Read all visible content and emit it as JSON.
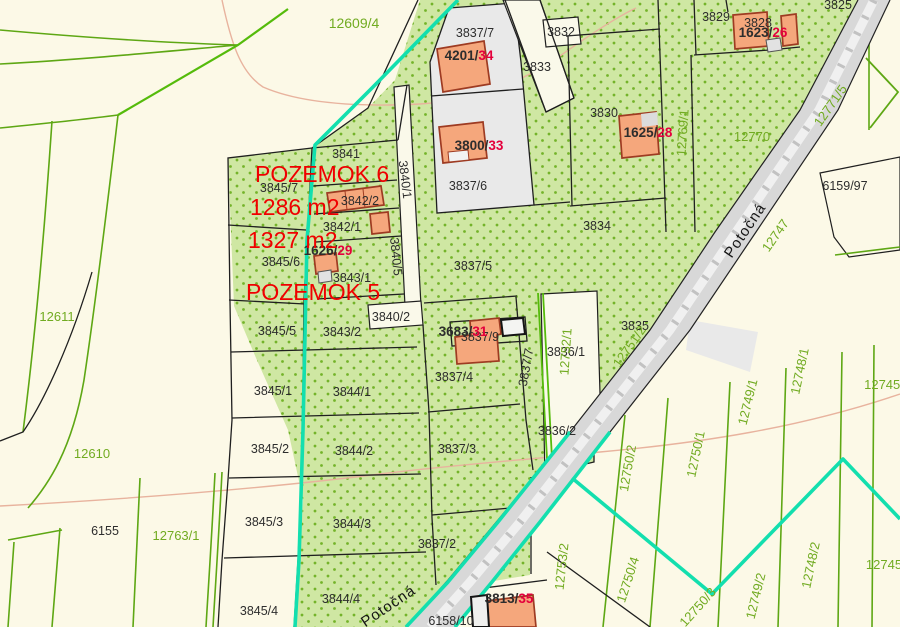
{
  "map_title": "cadastral-parcel-map",
  "colors": {
    "background": "#fcf9e7",
    "green_area": "#cfe7a3",
    "green_dot": "#74b32a",
    "gray_parcel": "#e9e9e9",
    "white_parcel": "#faf9ea",
    "road_fill": "#d8d8d8",
    "boundary_black": "#1f1f1f",
    "boundary_green": "#5ea714",
    "boundary_bright_green": "#55bb0b",
    "highlight_cyan": "#13dfae",
    "building_fill": "#f5a77c",
    "building_stroke": "#9e3b22",
    "contour_pink": "#e8b39e",
    "label_black": "#2d2d2d",
    "label_green": "#71ab21",
    "label_red": "#e4003c",
    "annotation_red": "#f00000",
    "street_black": "#151515"
  },
  "parcel_labels_black": [
    {
      "t": "3837/7",
      "x": 475,
      "y": 37
    },
    {
      "t": "3832",
      "x": 561,
      "y": 36
    },
    {
      "t": "3833",
      "x": 537,
      "y": 71
    },
    {
      "t": "3829",
      "x": 716,
      "y": 21
    },
    {
      "t": "3828",
      "x": 758,
      "y": 27
    },
    {
      "t": "3825",
      "x": 838,
      "y": 9
    },
    {
      "t": "3830",
      "x": 604,
      "y": 117
    },
    {
      "t": "3834",
      "x": 597,
      "y": 230
    },
    {
      "t": "6159/97",
      "x": 845,
      "y": 190
    },
    {
      "t": "3841",
      "x": 346,
      "y": 158
    },
    {
      "t": "3845/7",
      "x": 279,
      "y": 192
    },
    {
      "t": "3842/2",
      "x": 360,
      "y": 205
    },
    {
      "t": "3842/1",
      "x": 342,
      "y": 231
    },
    {
      "t": "3845/6",
      "x": 281,
      "y": 266
    },
    {
      "t": "3843/1",
      "x": 352,
      "y": 282
    },
    {
      "t": "3840/2",
      "x": 391,
      "y": 321
    },
    {
      "t": "3845/5",
      "x": 277,
      "y": 335
    },
    {
      "t": "3843/2",
      "x": 342,
      "y": 336
    },
    {
      "t": "3845/1",
      "x": 273,
      "y": 395
    },
    {
      "t": "3844/1",
      "x": 352,
      "y": 396
    },
    {
      "t": "3845/2",
      "x": 270,
      "y": 453
    },
    {
      "t": "3844/2",
      "x": 354,
      "y": 455
    },
    {
      "t": "3845/3",
      "x": 264,
      "y": 526
    },
    {
      "t": "3844/3",
      "x": 352,
      "y": 528
    },
    {
      "t": "3845/4",
      "x": 259,
      "y": 615
    },
    {
      "t": "3844/4",
      "x": 341,
      "y": 603
    },
    {
      "t": "3837/6",
      "x": 468,
      "y": 190
    },
    {
      "t": "3837/5",
      "x": 473,
      "y": 270
    },
    {
      "t": "3837/4",
      "x": 454,
      "y": 381
    },
    {
      "t": "3837/3",
      "x": 457,
      "y": 453
    },
    {
      "t": "3837/2",
      "x": 437,
      "y": 548
    },
    {
      "t": "3836/1",
      "x": 566,
      "y": 356
    },
    {
      "t": "3836/2",
      "x": 557,
      "y": 435
    },
    {
      "t": "3835",
      "x": 635,
      "y": 330
    },
    {
      "t": "6155",
      "x": 105,
      "y": 535
    },
    {
      "t": "6158/10",
      "x": 451,
      "y": 625
    },
    {
      "t": "3837/9",
      "x": 480,
      "y": 341,
      "u": 1
    },
    {
      "t": "3840/1",
      "x": 401,
      "y": 180,
      "r": 83
    },
    {
      "t": "3840/5",
      "x": 392,
      "y": 257,
      "r": 84
    },
    {
      "t": "3837/7",
      "x": 530,
      "y": 368,
      "r": -80
    }
  ],
  "parcel_labels_green": [
    {
      "t": "12609/4",
      "x": 354,
      "y": 28,
      "s": 14
    },
    {
      "t": "12611",
      "x": 57,
      "y": 321
    },
    {
      "t": "12610",
      "x": 92,
      "y": 458
    },
    {
      "t": "12763/1",
      "x": 176,
      "y": 540
    },
    {
      "t": "12770",
      "x": 752,
      "y": 141
    },
    {
      "t": "12769/1",
      "x": 687,
      "y": 133,
      "r": -86
    },
    {
      "t": "12747",
      "x": 779,
      "y": 238,
      "r": -55
    },
    {
      "t": "12771/5",
      "x": 834,
      "y": 108,
      "r": -55
    },
    {
      "t": "12751/2",
      "x": 633,
      "y": 349,
      "r": -55
    },
    {
      "t": "12752/1",
      "x": 570,
      "y": 352,
      "r": -86
    },
    {
      "t": "12753/2",
      "x": 566,
      "y": 567,
      "r": -84
    },
    {
      "t": "12750/2",
      "x": 632,
      "y": 469,
      "r": -80
    },
    {
      "t": "12750/1",
      "x": 700,
      "y": 455,
      "r": -78
    },
    {
      "t": "12750/4",
      "x": 632,
      "y": 581,
      "r": -72
    },
    {
      "t": "12750/3",
      "x": 701,
      "y": 610,
      "r": -48
    },
    {
      "t": "12749/2",
      "x": 760,
      "y": 597,
      "r": -76
    },
    {
      "t": "12748/2",
      "x": 815,
      "y": 566,
      "r": -78
    },
    {
      "t": "12749/1",
      "x": 752,
      "y": 403,
      "r": -76
    },
    {
      "t": "12748/1",
      "x": 804,
      "y": 372,
      "r": -78
    },
    {
      "t": "12745/",
      "x": 884,
      "y": 389
    },
    {
      "t": "12745",
      "x": 884,
      "y": 569
    }
  ],
  "building_labels": [
    {
      "black": "4201/",
      "red": "34",
      "x": 469,
      "y": 60
    },
    {
      "black": "1623/",
      "red": "26",
      "x": 763,
      "y": 37
    },
    {
      "black": "1625/",
      "red": "28",
      "x": 648,
      "y": 137
    },
    {
      "black": "3800/",
      "red": "33",
      "x": 479,
      "y": 150
    },
    {
      "black": "1626/",
      "red": "29",
      "x": 328,
      "y": 255
    },
    {
      "black": "3683/",
      "red": "31",
      "x": 463,
      "y": 336
    },
    {
      "black": "3813/",
      "red": "35",
      "x": 509,
      "y": 603
    }
  ],
  "street_labels": [
    {
      "t": "Potočná",
      "x": 749,
      "y": 233,
      "r": -56
    },
    {
      "t": "Potočná",
      "x": 391,
      "y": 610,
      "r": -34
    }
  ],
  "annotations": [
    {
      "t": "POZEMOK 6",
      "x": 255,
      "y": 182
    },
    {
      "t": "1286 m2",
      "x": 250,
      "y": 215
    },
    {
      "t": "1327 m2",
      "x": 248,
      "y": 248
    },
    {
      "t": "POZEMOK 5",
      "x": 246,
      "y": 300
    }
  ]
}
